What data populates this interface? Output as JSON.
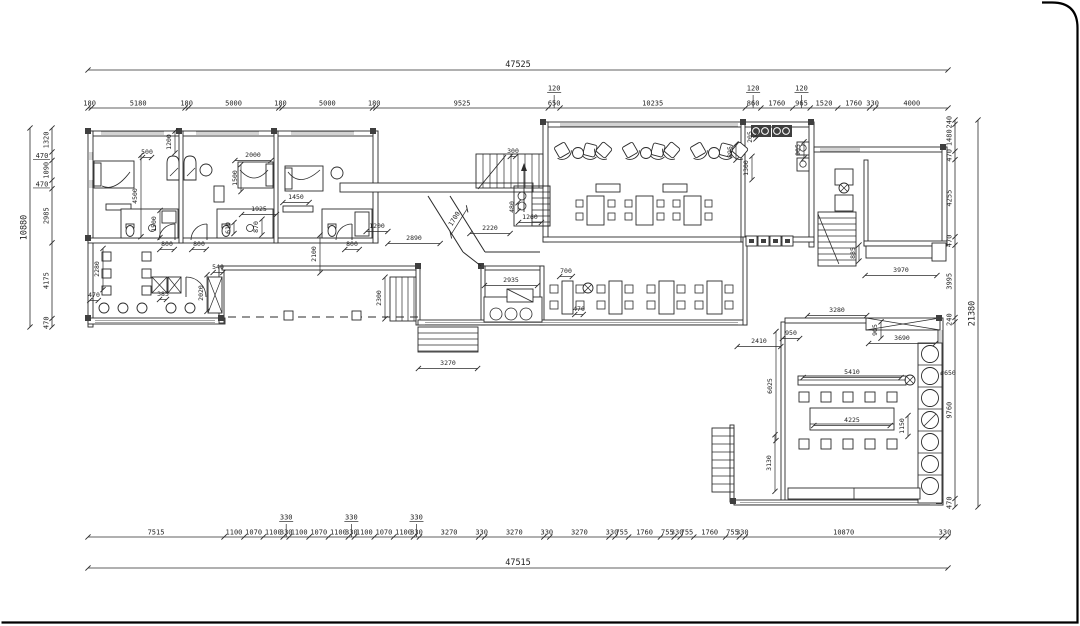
{
  "drawing_meta": {
    "type": "architectural-floor-plan",
    "units": "mm",
    "line_color": "#2b2b2b",
    "wall_fill": "#ffffff",
    "pier_fill": "#3f3f3f",
    "background": "#ffffff"
  },
  "overall_dims": {
    "top": "47525",
    "bottom": "47515",
    "left": "10880",
    "right": "21380"
  },
  "dim_chains": {
    "top": {
      "values": [
        180,
        5180,
        180,
        5000,
        180,
        5000,
        180,
        9525,
        650,
        10235,
        860,
        1760,
        965,
        1520,
        1760,
        330,
        4000
      ],
      "risers": [
        {
          "seg": 8,
          "label": "120"
        },
        {
          "seg": 10,
          "label": "120"
        },
        {
          "seg": 12,
          "label": "120"
        }
      ]
    },
    "bottom": {
      "values": [
        7515,
        1100,
        1070,
        1100,
        330,
        1100,
        1070,
        1100,
        330,
        1100,
        1070,
        1100,
        330,
        3270,
        330,
        3270,
        330,
        3270,
        330,
        755,
        1760,
        755,
        330,
        755,
        1760,
        755,
        330,
        10870,
        330
      ],
      "risers": [
        {
          "seg": 4,
          "label": "330"
        },
        {
          "seg": 8,
          "label": "330"
        },
        {
          "seg": 12,
          "label": "330"
        }
      ]
    },
    "left": {
      "values": [
        1320,
        470,
        1090,
        470,
        2985,
        4175,
        470
      ],
      "horizontal_label_segs": [
        1,
        3
      ]
    },
    "right": {
      "values": [
        240,
        1480,
        470,
        4255,
        470,
        3995,
        240,
        9760,
        470
      ],
      "horizontal_label_segs": []
    }
  },
  "interior_dims": [
    {
      "t": "500",
      "x": 147,
      "y": 154
    },
    {
      "t": "1200",
      "x": 171,
      "y": 142,
      "r": 1
    },
    {
      "t": "2000",
      "x": 253,
      "y": 157
    },
    {
      "t": "1500",
      "x": 237,
      "y": 178,
      "r": 1
    },
    {
      "t": "4500",
      "x": 137,
      "y": 196,
      "r": 1
    },
    {
      "t": "1500",
      "x": 156,
      "y": 224,
      "r": 1
    },
    {
      "t": "1925",
      "x": 259,
      "y": 211
    },
    {
      "t": "1450",
      "x": 296,
      "y": 199
    },
    {
      "t": "870",
      "x": 258,
      "y": 227,
      "r": 1
    },
    {
      "t": "610",
      "x": 230,
      "y": 228,
      "r": 1
    },
    {
      "t": "800",
      "x": 167,
      "y": 246
    },
    {
      "t": "800",
      "x": 199,
      "y": 246
    },
    {
      "t": "800",
      "x": 352,
      "y": 246
    },
    {
      "t": "2100",
      "x": 316,
      "y": 254,
      "r": 1
    },
    {
      "t": "1200",
      "x": 377,
      "y": 228
    },
    {
      "t": "2890",
      "x": 414,
      "y": 240
    },
    {
      "t": "1700",
      "x": 456,
      "y": 220,
      "d": 1
    },
    {
      "t": "300",
      "x": 513,
      "y": 153
    },
    {
      "t": "480",
      "x": 514,
      "y": 207,
      "r": 1
    },
    {
      "t": "1260",
      "x": 530,
      "y": 219
    },
    {
      "t": "2220",
      "x": 490,
      "y": 230
    },
    {
      "t": "2300",
      "x": 381,
      "y": 298,
      "r": 1
    },
    {
      "t": "3270",
      "x": 448,
      "y": 365
    },
    {
      "t": "540",
      "x": 218,
      "y": 269
    },
    {
      "t": "385",
      "x": 163,
      "y": 296
    },
    {
      "t": "2020",
      "x": 203,
      "y": 293,
      "r": 1
    },
    {
      "t": "2280",
      "x": 99,
      "y": 269,
      "r": 1
    },
    {
      "t": "470",
      "x": 94,
      "y": 297
    },
    {
      "t": "895",
      "x": 732,
      "y": 152,
      "r": 1
    },
    {
      "t": "205",
      "x": 752,
      "y": 137,
      "r": 1
    },
    {
      "t": "1300",
      "x": 748,
      "y": 168,
      "r": 1
    },
    {
      "t": "905",
      "x": 800,
      "y": 150,
      "r": 1
    },
    {
      "t": "2935",
      "x": 511,
      "y": 282
    },
    {
      "t": "700",
      "x": 566,
      "y": 273
    },
    {
      "t": "470",
      "x": 579,
      "y": 311
    },
    {
      "t": "885",
      "x": 855,
      "y": 253,
      "r": 1
    },
    {
      "t": "3970",
      "x": 901,
      "y": 272
    },
    {
      "t": "3280",
      "x": 837,
      "y": 312
    },
    {
      "t": "950",
      "x": 791,
      "y": 335
    },
    {
      "t": "2410",
      "x": 759,
      "y": 343
    },
    {
      "t": "3690",
      "x": 902,
      "y": 340
    },
    {
      "t": "905",
      "x": 877,
      "y": 330,
      "r": 1
    },
    {
      "t": "6025",
      "x": 772,
      "y": 386,
      "r": 1
    },
    {
      "t": "5410",
      "x": 852,
      "y": 374
    },
    {
      "t": "ø650",
      "x": 948,
      "y": 375
    },
    {
      "t": "4225",
      "x": 852,
      "y": 422
    },
    {
      "t": "1150",
      "x": 904,
      "y": 426,
      "r": 1
    },
    {
      "t": "3130",
      "x": 771,
      "y": 463,
      "r": 1
    }
  ]
}
